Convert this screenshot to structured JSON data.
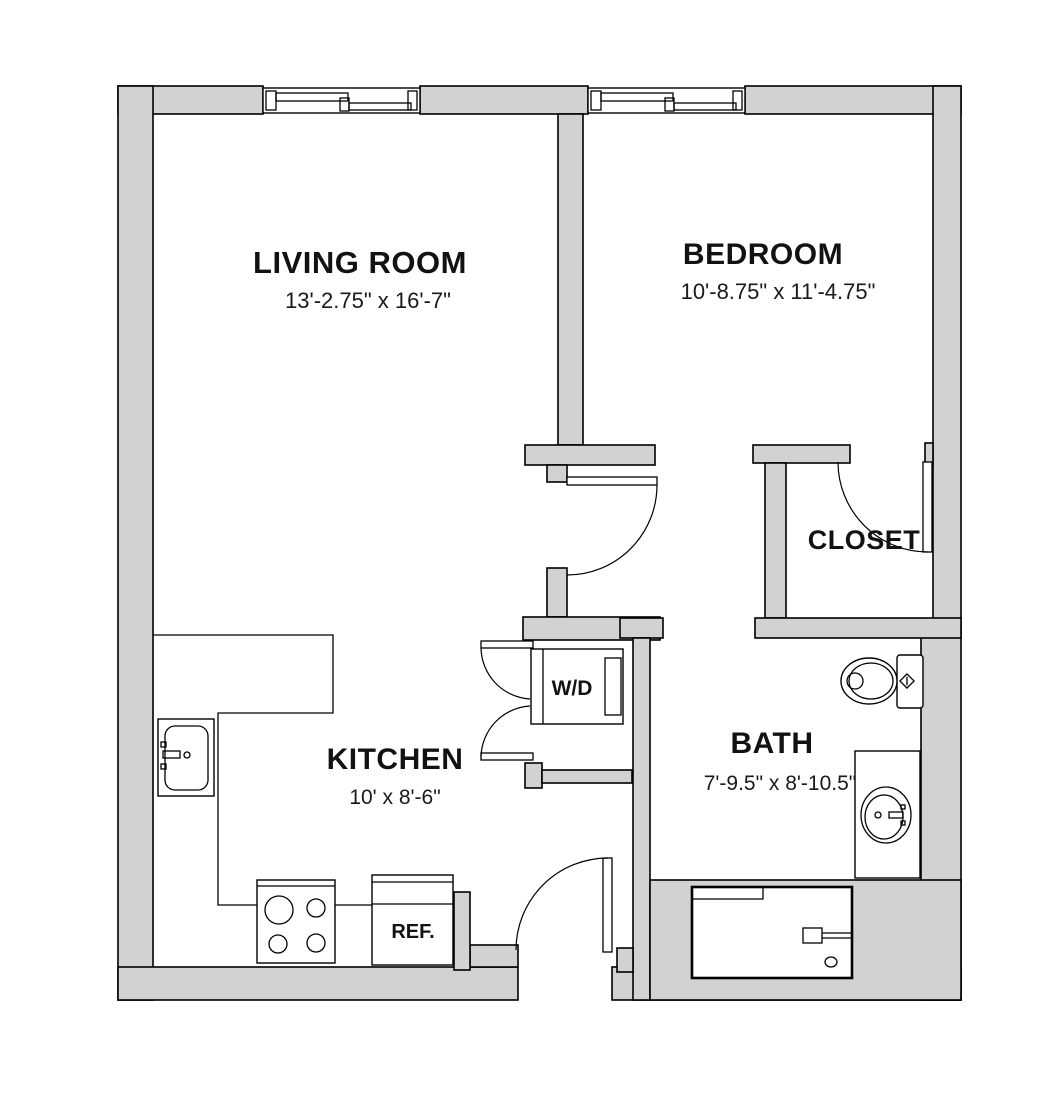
{
  "plan": {
    "title": "One-bedroom apartment floor plan",
    "rooms": [
      {
        "name": "living-room",
        "label": "LIVING ROOM",
        "dimensions": "13'-2.75\" x 16'-7\""
      },
      {
        "name": "bedroom",
        "label": "BEDROOM",
        "dimensions": "10'-8.75\" x 11'-4.75\""
      },
      {
        "name": "closet",
        "label": "CLOSET",
        "dimensions": ""
      },
      {
        "name": "kitchen",
        "label": "KITCHEN",
        "dimensions": "10' x 8'-6\""
      },
      {
        "name": "bath",
        "label": "BATH",
        "dimensions": "7'-9.5\" x 8'-10.5\""
      }
    ],
    "fixtures": [
      {
        "name": "washer-dryer",
        "label": "W/D"
      },
      {
        "name": "refrigerator",
        "label": "REF."
      },
      {
        "name": "stove",
        "label": ""
      },
      {
        "name": "kitchen-sink",
        "label": ""
      },
      {
        "name": "toilet",
        "label": ""
      },
      {
        "name": "bathroom-vanity-sink",
        "label": ""
      },
      {
        "name": "bathtub",
        "label": ""
      },
      {
        "name": "living-room-window",
        "label": ""
      },
      {
        "name": "bedroom-window",
        "label": ""
      }
    ],
    "colors": {
      "wall_fill": "#d2d2d2",
      "line": "#000000",
      "background": "#ffffff",
      "text": "#121212"
    }
  }
}
